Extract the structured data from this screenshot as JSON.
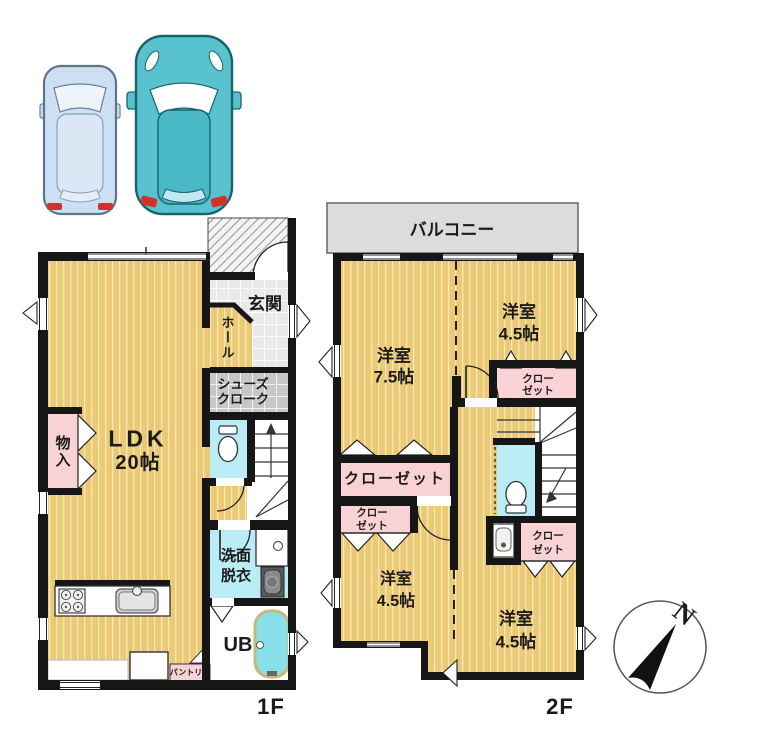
{
  "palette": {
    "floor_wood": "#ecca74",
    "closet_pink": "#f8d2d4",
    "water_cyan": "#b9ecf4",
    "bathtub_cyan": "#86dfe9",
    "balcony_gray": "#dcdcdc",
    "genkan_tile": "#e9e9e9",
    "cloak_tile": "#c7c7c7",
    "wall_black": "#161616",
    "car_small_blue": "#cddff2",
    "car_large_teal": "#58c3cf",
    "taillight_red": "#d43127"
  },
  "floor1": {
    "floor_label": "1F",
    "ldk": {
      "name": "LDK",
      "size": "20帖"
    },
    "genkan": "玄関",
    "hall": "ホール",
    "shoes_cloak": {
      "line1": "シューズ",
      "line2": "クローク"
    },
    "storage": "物入",
    "washroom": {
      "line1": "洗面",
      "line2": "脱衣"
    },
    "bath": "UB",
    "pantry": "パントリー"
  },
  "floor2": {
    "floor_label": "2F",
    "balcony": "バルコニー",
    "room_75": {
      "name": "洋室",
      "size": "7.5帖"
    },
    "room_45_top": {
      "name": "洋室",
      "size": "4.5帖"
    },
    "room_45_left": {
      "name": "洋室",
      "size": "4.5帖"
    },
    "room_45_right": {
      "name": "洋室",
      "size": "4.5帖"
    },
    "closet_main": "クローゼット",
    "closet_small": {
      "line1": "クロー",
      "line2": "ゼット"
    }
  },
  "compass": {
    "north": "N"
  }
}
